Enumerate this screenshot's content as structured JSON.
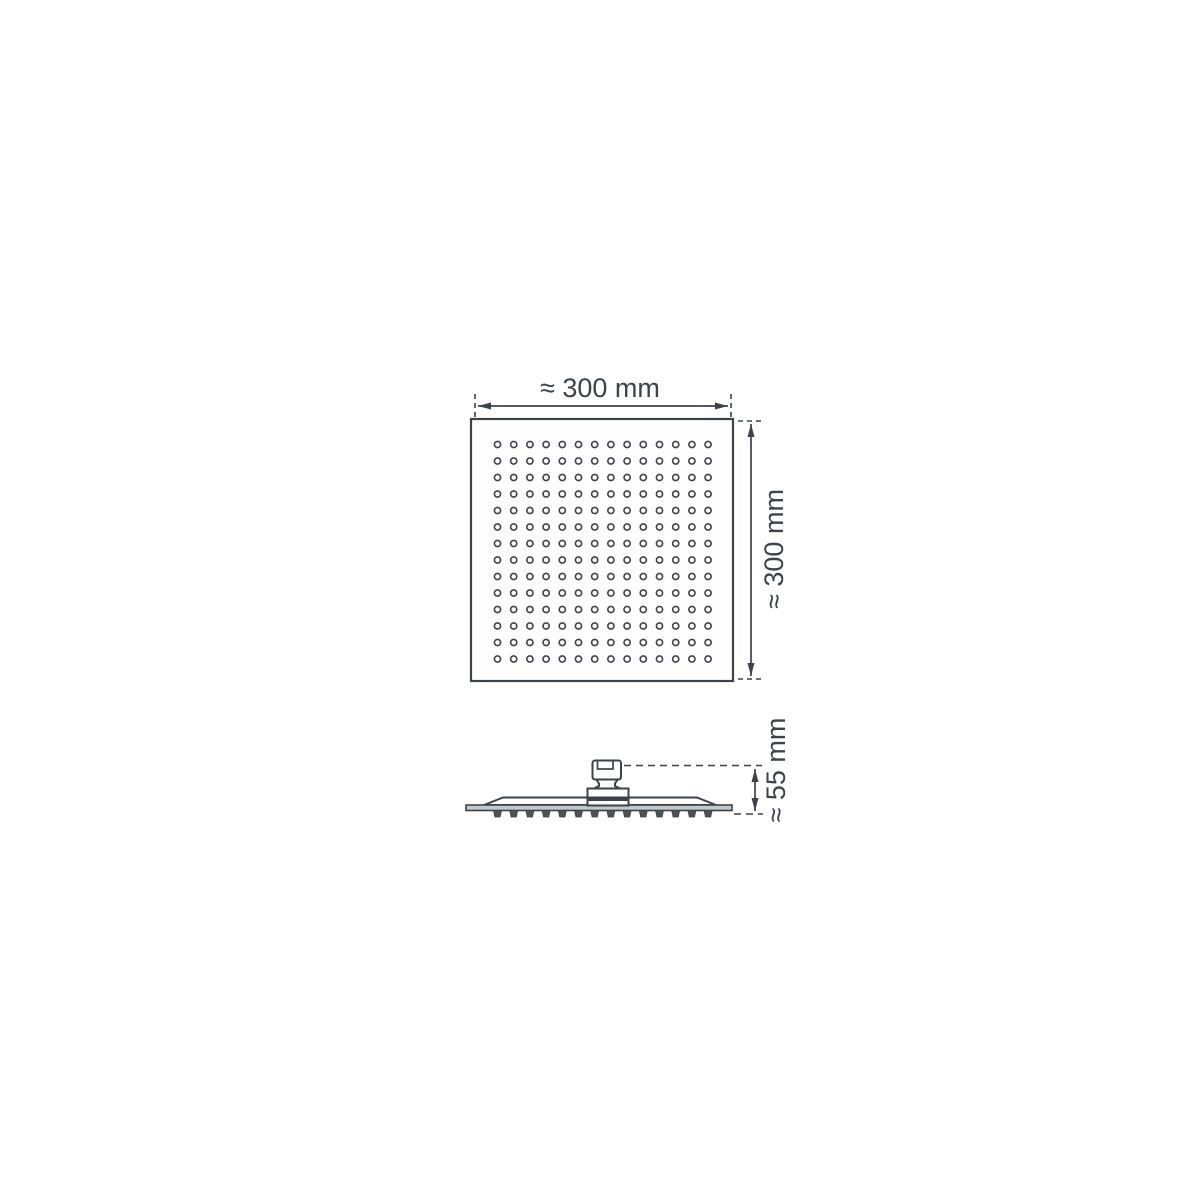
{
  "labels": {
    "width": "≈ 300 mm",
    "height": "≈ 300 mm",
    "depth": "≈ 55 mm"
  },
  "top_view": {
    "nozzle_grid": {
      "rows": 14,
      "cols": 14
    }
  },
  "side_view": {
    "nozzle_count": 14
  },
  "colors": {
    "line": "#3c434a",
    "plate_fill": "#c3c8cb",
    "tooth_fill": "#4b5258",
    "background": "#ffffff"
  }
}
